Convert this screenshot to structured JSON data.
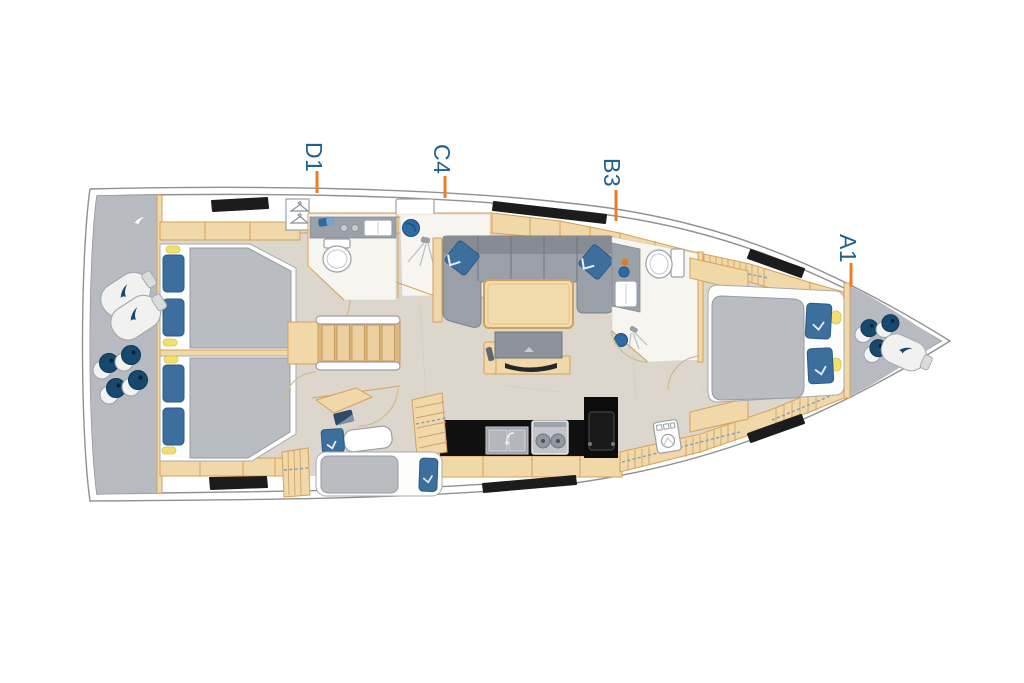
{
  "diagram": {
    "kind": "sailing-yacht-interior-floor-plan",
    "orientation": "bow-right",
    "labels": [
      {
        "id": "d1",
        "text": "D1"
      },
      {
        "id": "c4",
        "text": "C4"
      },
      {
        "id": "b3",
        "text": "B3"
      },
      {
        "id": "a1",
        "text": "A1"
      }
    ],
    "colors": {
      "label_text": "#20618f",
      "tick_orange": "#ee7d22",
      "hull_line": "#909094",
      "deck_cream": "#f4f0e6",
      "deck_grey": "#b7bbc1",
      "floor_greige": "#dcd6cd",
      "wood_tan": "#f0d8a8",
      "wood_edge": "#d5a159",
      "upholstery_grey": "#9aa0a8",
      "mattress_grey": "#b9bcc1",
      "cushion_blue": "#3c6f9d",
      "rope_navy": "#17486e",
      "light_yellow": "#f1df72",
      "window_black": "#1c1c1c",
      "galley_black": "#101010"
    },
    "icon_names": [
      "double-berth-icon",
      "single-berth-icon",
      "island-berth-icon",
      "pillow-icon",
      "reading-light-icon",
      "wardrobe-hanger-icon",
      "toilet-icon",
      "washbasin-icon",
      "shower-head-icon",
      "shower-drain-icon",
      "sofa-icon",
      "saloon-table-icon",
      "tv-sideboard-icon",
      "galley-sink-icon",
      "stove-icon",
      "fridge-icon",
      "companionway-stairs-icon",
      "deck-hatch-window-icon",
      "fender-icon",
      "mooring-line-icon",
      "washing-machine-icon"
    ]
  }
}
